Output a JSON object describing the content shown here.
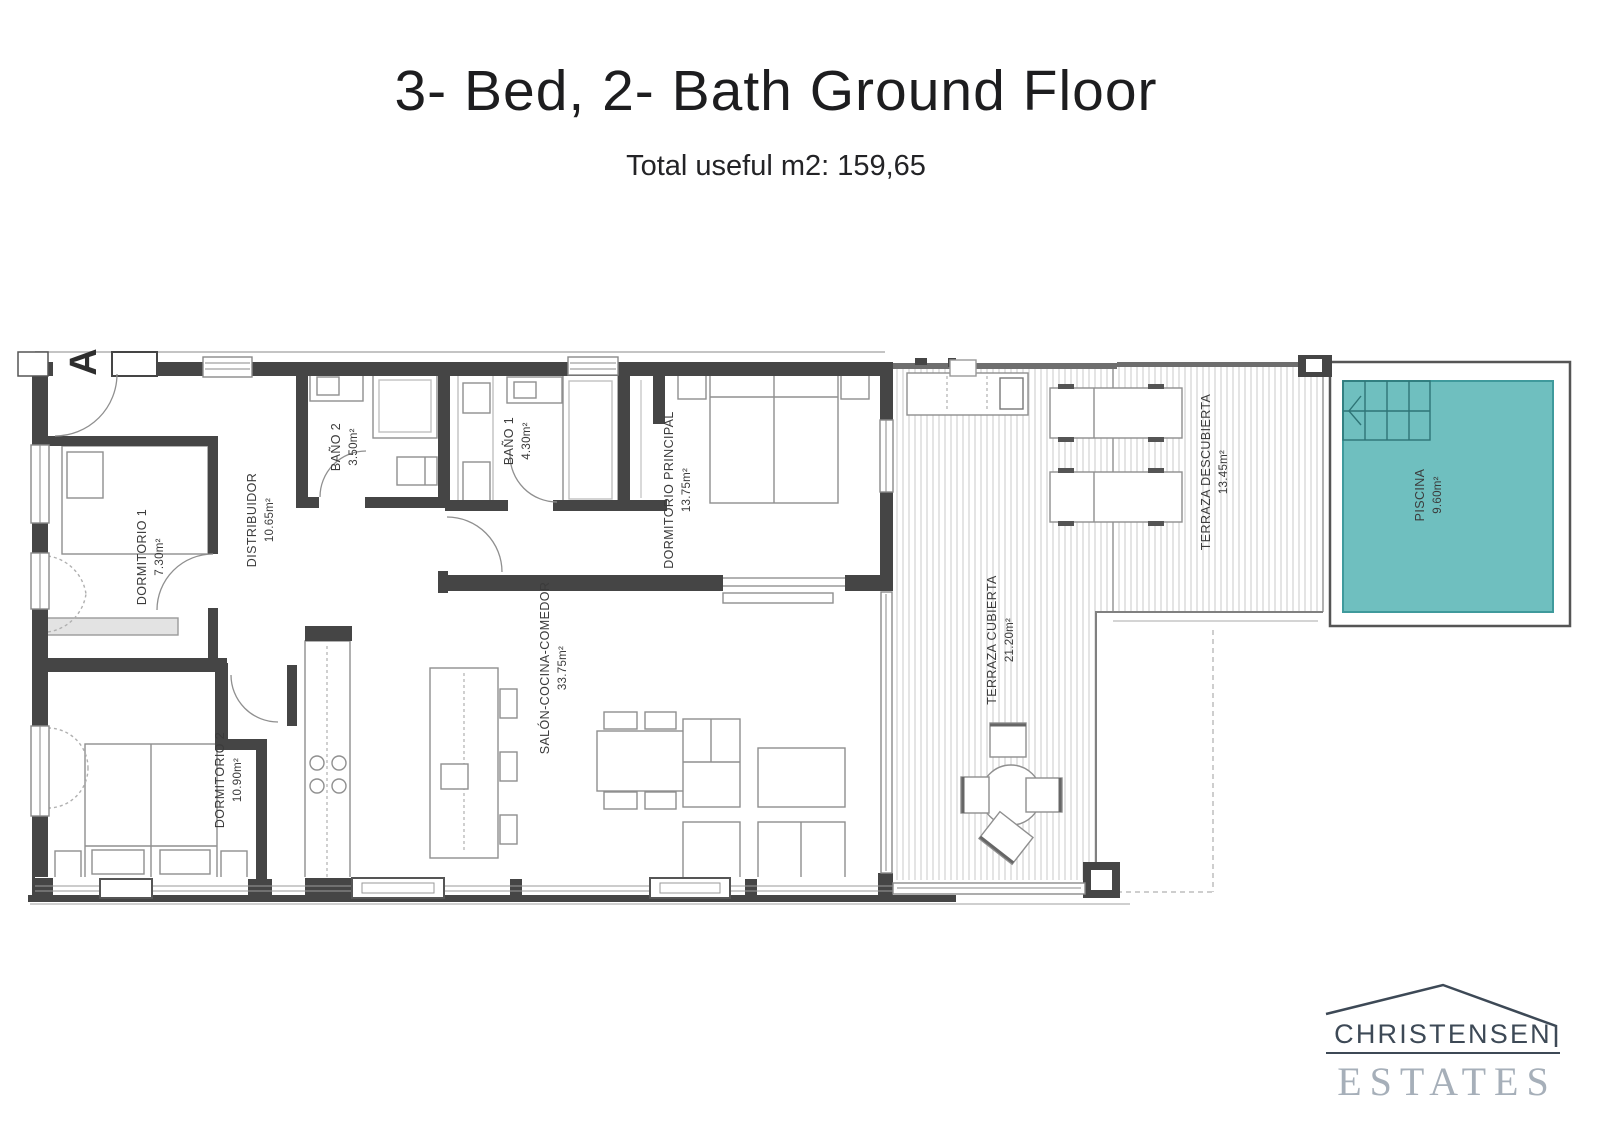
{
  "page": {
    "title": "3- Bed, 2- Bath Ground Floor",
    "subtitle": "Total useful m2: 159,65"
  },
  "floor_plan": {
    "section_marker": "A",
    "rooms": [
      {
        "id": "dormitorio1",
        "name": "DORMITORIO 1",
        "area": "7.30m²"
      },
      {
        "id": "distribuidor",
        "name": "DISTRIBUIDOR",
        "area": "10.65m²"
      },
      {
        "id": "bano2",
        "name": "BAÑO 2",
        "area": "3.50m²"
      },
      {
        "id": "bano1",
        "name": "BAÑO 1",
        "area": "4.30m²"
      },
      {
        "id": "dormitorio_principal",
        "name": "DORMITORIO PRINCIPAL",
        "area": "13.75m²"
      },
      {
        "id": "dormitorio2",
        "name": "DORMITORIO 2",
        "area": "10.90m²"
      },
      {
        "id": "salon_cocina_comedor",
        "name": "SALÓN-COCINA-COMEDOR",
        "area": "33.75m²"
      },
      {
        "id": "terraza_cubierta",
        "name": "TERRAZA CUBIERTA",
        "area": "21.20m²"
      },
      {
        "id": "terraza_descubierta",
        "name": "TERRAZA DESCUBIERTA",
        "area": "13.45m²"
      },
      {
        "id": "piscina",
        "name": "PISCINA",
        "area": "9.60m²"
      }
    ],
    "colors": {
      "pool_fill": "#6fbfbf",
      "pool_border": "#3f9a9c",
      "wall": "#454545",
      "deck_stripe": "#d2d2d2"
    }
  },
  "logo": {
    "line1": "CHRISTENSEN",
    "line2": "ESTATES"
  }
}
